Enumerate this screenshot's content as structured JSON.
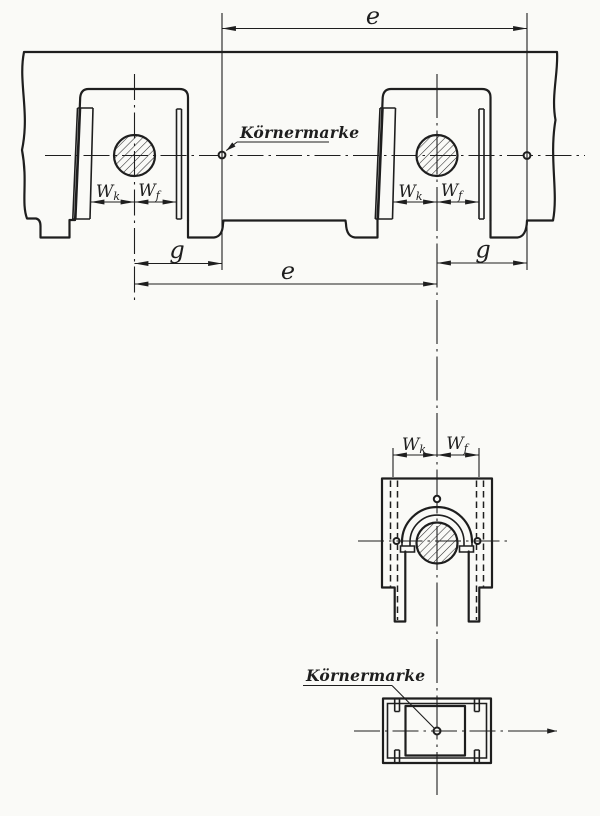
{
  "page": {
    "paper_color": "#fafaf7",
    "ink_color": "#1e1e1e"
  },
  "labels": {
    "pitch": "e",
    "gap": "g",
    "w_base": "W",
    "w_sub_k": "k",
    "w_sub_f": "f",
    "center_punch_mark": "Körnermarke"
  }
}
